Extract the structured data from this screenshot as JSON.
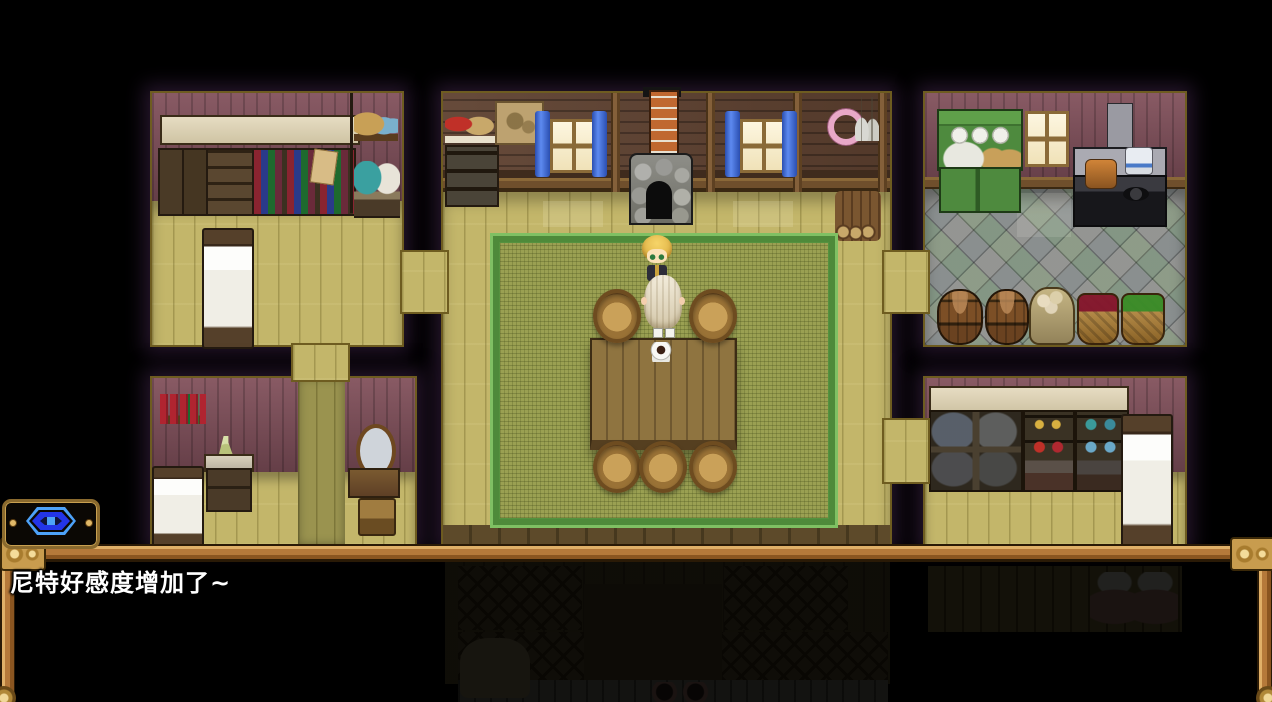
{
  "dialogue": {
    "text": "尼特好感度增加了~"
  },
  "hud": {
    "eye_button_icon": "eye-icon"
  },
  "colors": {
    "frame_wood": "#b5793a",
    "frame_gold": "#e0c078",
    "eye_outer_blue": "#4da2f8",
    "eye_inner_blue": "#2335e8",
    "dialogue_text": "#ffffff",
    "floor": "#c3b66a",
    "wall": "#7b4c57",
    "rug": "#9aa052",
    "curtain": "#3565d8"
  }
}
